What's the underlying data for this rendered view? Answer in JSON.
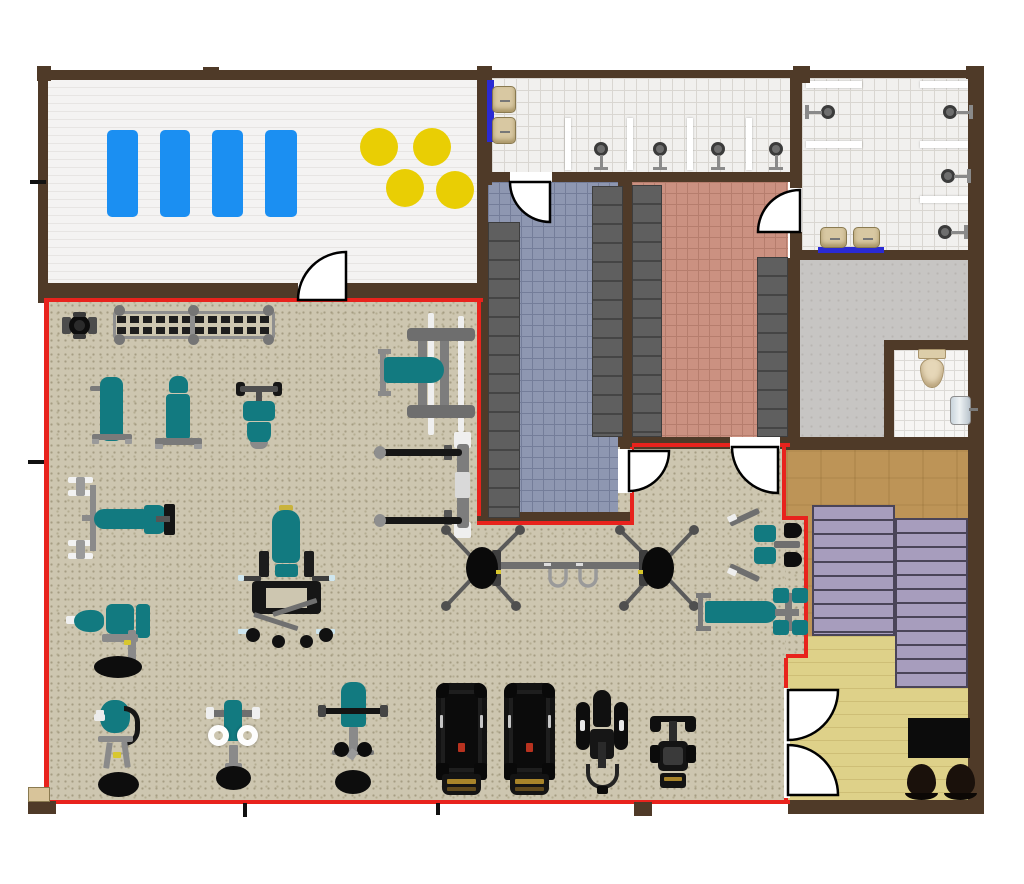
{
  "document": {
    "kind": "gym-floor-plan",
    "visible_text": []
  },
  "palette": {
    "wall": "#4f3a28",
    "outline_red": "#e8231d",
    "plank_a": "#f4f3f2",
    "plank_b": "#e7e5e3",
    "tile_bg": "#f1f0ee",
    "tile_line": "#d9d6d1",
    "blue_bg": "#8e97b1",
    "blue_line": "#747d99",
    "salmon_bg": "#cb9181",
    "salmon_line": "#b67d6d",
    "concrete": "#c7c5c3",
    "bath_bg": "#f6f5f3",
    "bath_line": "#dcdad6",
    "wood_dark": "#bd9457",
    "wood_light": "#ded189",
    "gym_bg": "#cdc6b0",
    "gym_dot": "#a59d83",
    "teal": "#127a80",
    "machine_gray": "#7a7a7a",
    "machine_dark": "#0d0d0d",
    "mat_blue": "#1b8ff2",
    "ball_yellow": "#e9ce04",
    "locker": "#5f5f5f",
    "locker_line": "#454545",
    "bench_purple": "#a79dbd",
    "bench_line": "#4a4458",
    "counter_blue": "#2a2ad4",
    "sink_beige": "#d8c8a2",
    "sink_edge": "#8a7a50",
    "door_stroke": "#000000",
    "desk_black": "#0c0c0c",
    "chair_dark": "#1a110b"
  },
  "rooms": [
    {
      "id": "main-gym-floor",
      "floor": "speckle",
      "rects": [
        [
          48,
          302,
          740,
          498
        ]
      ]
    },
    {
      "id": "group-fitness-studio",
      "floor": "plank_white",
      "rects": [
        [
          48,
          80,
          430,
          205
        ]
      ]
    },
    {
      "id": "shower-room-a",
      "floor": "tile_white",
      "rects": [
        [
          492,
          78,
          298,
          96
        ]
      ]
    },
    {
      "id": "locker-room-blue",
      "floor": "tile_blue",
      "rects": [
        [
          488,
          182,
          130,
          330
        ]
      ]
    },
    {
      "id": "locker-room-salmon",
      "floor": "tile_salmon",
      "rects": [
        [
          632,
          182,
          156,
          255
        ]
      ]
    },
    {
      "id": "shower-room-b",
      "floor": "tile_white",
      "rects": [
        [
          802,
          78,
          166,
          174
        ]
      ]
    },
    {
      "id": "utility-room",
      "floor": "concrete",
      "rects": [
        [
          798,
          260,
          170,
          190
        ]
      ]
    },
    {
      "id": "restroom",
      "floor": "tile_bath",
      "rects": [
        [
          894,
          350,
          74,
          90
        ]
      ]
    },
    {
      "id": "sauna-area",
      "floor": "wood_dark",
      "rects": [
        [
          786,
          450,
          182,
          190
        ]
      ]
    },
    {
      "id": "reception",
      "floor": "wood_light",
      "rects": [
        [
          786,
          636,
          182,
          164
        ]
      ]
    },
    {
      "id": "gym-annex",
      "floor": "speckle",
      "rects": [
        [
          786,
          520,
          20,
          136
        ]
      ]
    }
  ],
  "walls": [
    [
      38,
      70,
      445,
      10
    ],
    [
      38,
      70,
      10,
      233
    ],
    [
      38,
      283,
      445,
      17
    ],
    [
      477,
      70,
      15,
      115
    ],
    [
      483,
      70,
      501,
      8
    ],
    [
      968,
      70,
      16,
      744
    ],
    [
      790,
      70,
      12,
      188
    ],
    [
      483,
      172,
      319,
      10
    ],
    [
      618,
      182,
      14,
      265
    ],
    [
      477,
      182,
      11,
      343
    ],
    [
      477,
      512,
      157,
      13
    ],
    [
      620,
      437,
      170,
      12
    ],
    [
      788,
      258,
      12,
      192
    ],
    [
      800,
      250,
      168,
      10
    ],
    [
      884,
      340,
      84,
      10
    ],
    [
      884,
      340,
      10,
      109
    ],
    [
      786,
      437,
      182,
      13
    ],
    [
      788,
      800,
      196,
      14
    ]
  ],
  "red_outline": [
    [
      46,
      298,
      437,
      4
    ],
    [
      44,
      298,
      5,
      506
    ],
    [
      44,
      800,
      746,
      4
    ],
    [
      477,
      302,
      4,
      214
    ],
    [
      477,
      521,
      157,
      4
    ],
    [
      630,
      447,
      4,
      78
    ],
    [
      632,
      443,
      158,
      4
    ],
    [
      782,
      447,
      4,
      71
    ],
    [
      782,
      516,
      26,
      4
    ],
    [
      804,
      518,
      4,
      140
    ],
    [
      786,
      654,
      22,
      4
    ],
    [
      784,
      658,
      4,
      146
    ]
  ],
  "doors": [
    {
      "id": "door-studio",
      "gap": [
        298,
        283,
        48,
        17
      ],
      "path": "M346,300 L346,252 A48,48 0 0 0 298,300 Z"
    },
    {
      "id": "door-locker-blue",
      "gap": [
        510,
        172,
        42,
        10
      ],
      "path": "M550,182 L510,182 A40,40 0 0 0 550,222 Z"
    },
    {
      "id": "door-locker-salmon-shower",
      "gap": [
        790,
        188,
        12,
        44
      ],
      "path": "M800,232 L800,190 A42,42 0 0 0 758,232 Z"
    },
    {
      "id": "door-blue-to-gym",
      "gap": [
        618,
        449,
        14,
        44
      ],
      "path": "M629,451 L669,451 A40,40 0 0 1 629,491 Z"
    },
    {
      "id": "door-salmon-to-gym",
      "gap": [
        730,
        437,
        50,
        12
      ],
      "path": "M778,447 L732,447 A46,46 0 0 0 778,493 Z"
    },
    {
      "id": "double-door-reception-a",
      "gap": [
        784,
        688,
        6,
        110
      ],
      "path": "M788,690 L838,690 A50,50 0 0 1 788,740 Z"
    },
    {
      "id": "double-door-reception-b",
      "gap": null,
      "path": "M788,795 L838,795 A50,50 0 0 0 788,745 Z"
    }
  ],
  "fixtures": {
    "mats": [
      [
        107,
        130,
        31,
        87
      ],
      [
        160,
        130,
        30,
        87
      ],
      [
        212,
        130,
        31,
        87
      ],
      [
        265,
        130,
        32,
        87
      ]
    ],
    "balls": {
      "r": 19,
      "centers": [
        [
          379,
          147
        ],
        [
          432,
          147
        ],
        [
          405,
          188
        ],
        [
          455,
          190
        ]
      ]
    },
    "partitions_v": [
      [
        565,
        118,
        6,
        52
      ],
      [
        627,
        118,
        6,
        52
      ],
      [
        687,
        118,
        6,
        52
      ],
      [
        746,
        118,
        6,
        52
      ]
    ],
    "partitions_h": [
      [
        806,
        81,
        56,
        7
      ],
      [
        920,
        81,
        48,
        7
      ],
      [
        806,
        141,
        56,
        7
      ],
      [
        920,
        141,
        48,
        7
      ],
      [
        920,
        196,
        48,
        7
      ]
    ],
    "showers_down": [
      [
        601,
        150
      ],
      [
        660,
        150
      ],
      [
        718,
        150
      ],
      [
        776,
        150
      ]
    ],
    "showers_left": [
      [
        828,
        112
      ]
    ],
    "showers_right": [
      [
        950,
        112
      ],
      [
        948,
        176
      ],
      [
        945,
        232
      ]
    ],
    "sinks": [
      [
        492,
        86,
        24,
        27
      ],
      [
        492,
        117,
        24,
        27
      ],
      [
        820,
        227,
        27,
        21
      ],
      [
        853,
        227,
        27,
        21
      ]
    ],
    "counters": [
      [
        487,
        80,
        7,
        62
      ],
      [
        818,
        247,
        66,
        6
      ]
    ],
    "lockers": [
      [
        488,
        222,
        32,
        296
      ],
      [
        592,
        186,
        31,
        251
      ],
      [
        632,
        185,
        30,
        252
      ],
      [
        757,
        257,
        31,
        180
      ]
    ],
    "toilet": {
      "x": 918,
      "y": 349
    },
    "bath_sink": {
      "x": 950,
      "y": 396
    },
    "sauna_benches": [
      [
        812,
        505,
        83,
        131
      ],
      [
        895,
        518,
        73,
        170
      ]
    ],
    "desk": [
      908,
      718,
      62,
      40
    ],
    "chairs": [
      [
        905,
        764,
        33,
        38
      ],
      [
        944,
        764,
        33,
        38
      ]
    ],
    "posts_dark": [
      [
        37,
        66,
        14,
        15
      ],
      [
        203,
        67,
        16,
        13
      ],
      [
        477,
        66,
        15,
        14
      ],
      [
        793,
        66,
        17,
        17
      ],
      [
        966,
        66,
        18,
        13
      ],
      [
        634,
        802,
        18,
        14
      ],
      [
        28,
        801,
        28,
        13
      ]
    ],
    "posts_light": [
      [
        28,
        787,
        22,
        15
      ]
    ],
    "ticks": [
      [
        30,
        180,
        16,
        4
      ],
      [
        28,
        460,
        16,
        4
      ],
      [
        243,
        803,
        4,
        14
      ],
      [
        436,
        803,
        4,
        12
      ]
    ]
  },
  "equipment": [
    {
      "id": "press-station",
      "type": "press_top",
      "x": 62,
      "y": 312,
      "w": 35,
      "h": 27
    },
    {
      "id": "dumbbell-rack",
      "type": "db_rack",
      "x": 113,
      "y": 305,
      "w": 162,
      "h": 40
    },
    {
      "id": "adjustable-bench-1",
      "type": "bench_v",
      "x": 90,
      "y": 377,
      "w": 44,
      "h": 70
    },
    {
      "id": "adjustable-bench-2",
      "type": "bench_v2",
      "x": 155,
      "y": 376,
      "w": 47,
      "h": 74
    },
    {
      "id": "shoulder-press-machine",
      "type": "sh_press",
      "x": 236,
      "y": 380,
      "w": 46,
      "h": 70
    },
    {
      "id": "bench-press-station",
      "type": "bench_press",
      "x": 378,
      "y": 313,
      "w": 100,
      "h": 122
    },
    {
      "id": "barbell-rack",
      "type": "smith",
      "x": 374,
      "y": 432,
      "w": 102,
      "h": 106
    },
    {
      "id": "leg-press-machine",
      "type": "leg_press",
      "x": 68,
      "y": 477,
      "w": 116,
      "h": 82
    },
    {
      "id": "leg-curl-machine",
      "type": "leg_curl",
      "x": 66,
      "y": 600,
      "w": 92,
      "h": 78
    },
    {
      "id": "squat-machine",
      "type": "squat",
      "x": 238,
      "y": 505,
      "w": 97,
      "h": 143
    },
    {
      "id": "cable-crossover",
      "type": "crossover",
      "x": 436,
      "y": 522,
      "w": 268,
      "h": 92
    },
    {
      "id": "pec-deck-machine",
      "type": "pec_deck",
      "x": 728,
      "y": 517,
      "w": 76,
      "h": 56
    },
    {
      "id": "flat-bench",
      "type": "bench_h",
      "x": 696,
      "y": 588,
      "w": 110,
      "h": 48
    },
    {
      "id": "treadmill-1",
      "type": "treadmill",
      "x": 436,
      "y": 683,
      "w": 51,
      "h": 114
    },
    {
      "id": "treadmill-2",
      "type": "treadmill",
      "x": 504,
      "y": 683,
      "w": 51,
      "h": 114
    },
    {
      "id": "elliptical-trainer",
      "type": "elliptical",
      "x": 576,
      "y": 690,
      "w": 52,
      "h": 104
    },
    {
      "id": "exercise-bike",
      "type": "bike",
      "x": 650,
      "y": 716,
      "w": 46,
      "h": 74
    },
    {
      "id": "lat-pulldown-machine",
      "type": "pulldown",
      "x": 92,
      "y": 700,
      "w": 52,
      "h": 98
    },
    {
      "id": "rear-delt-machine",
      "type": "rear_delt",
      "x": 206,
      "y": 700,
      "w": 54,
      "h": 92
    },
    {
      "id": "seated-curl-machine",
      "type": "curl",
      "x": 318,
      "y": 682,
      "w": 70,
      "h": 113
    }
  ]
}
